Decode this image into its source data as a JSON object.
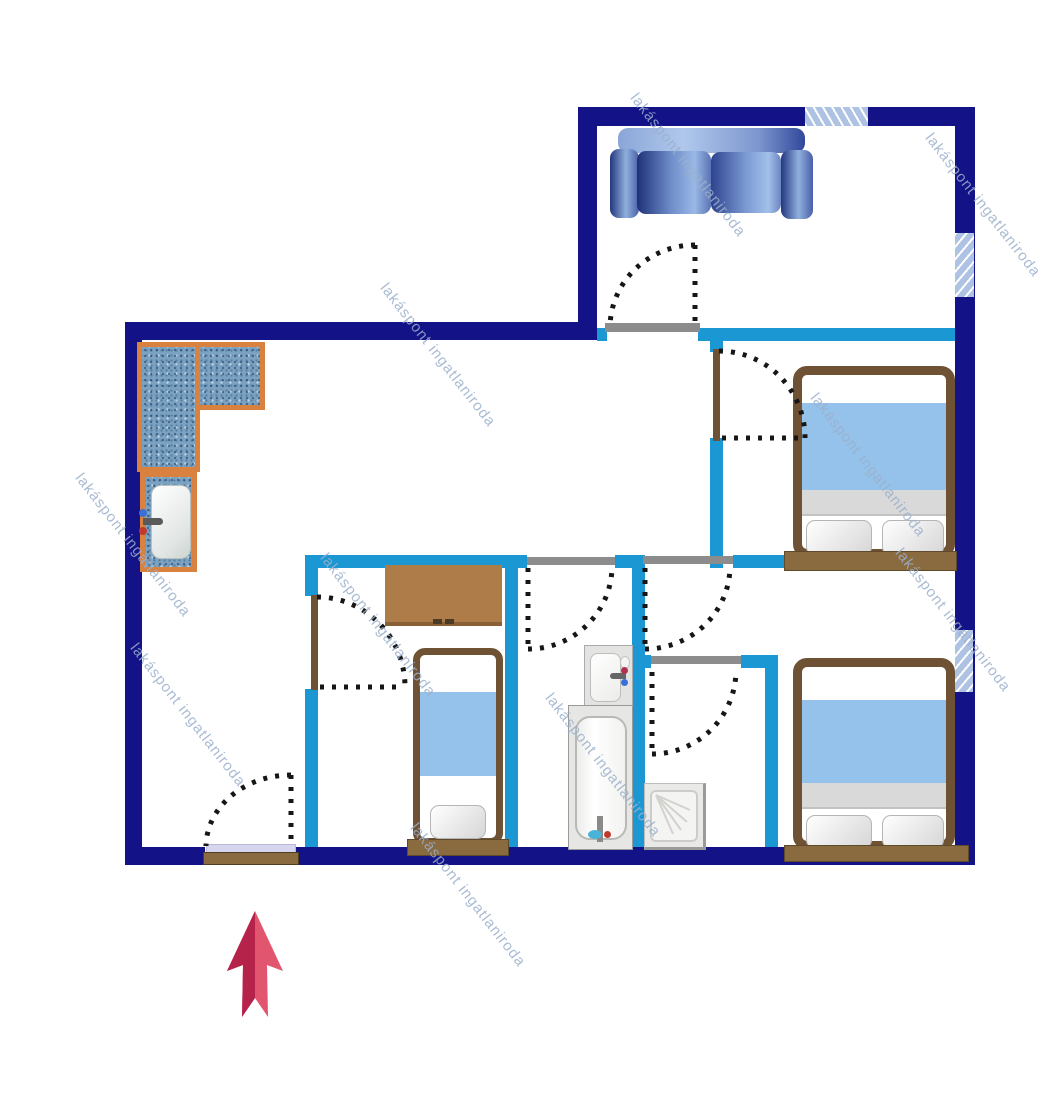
{
  "watermark": {
    "text": "lakáspont ingatlaniroda"
  },
  "colors": {
    "exterior_wall": "#131287",
    "interior_wall": "#1b97d4",
    "window_fill": "#aec3e4",
    "lintel_gray": "#8c8c8c",
    "wood_dark": "#6e5233",
    "wood_mid": "#8a6a3f",
    "desk_wood": "#ad7c48",
    "blanket_blue": "#95c2ea",
    "counter_border": "#d9813f",
    "counter_fill": "#7ba2c1",
    "door_dash": "#161616",
    "threshold_lavender": "#d6d6ee",
    "arrow_light": "#e2556f",
    "arrow_dark": "#b5224a",
    "watermark": "#9bb0cc"
  }
}
